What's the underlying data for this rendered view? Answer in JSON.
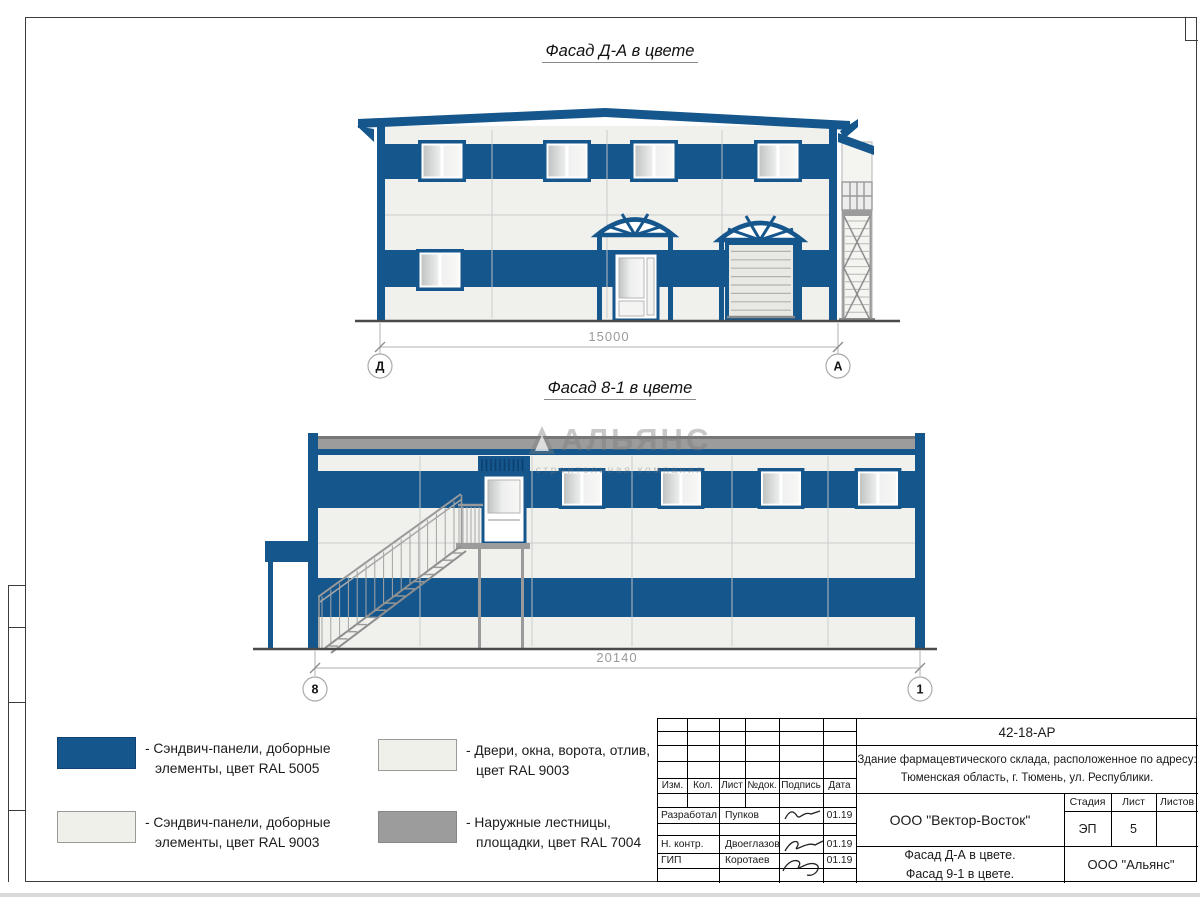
{
  "titles": {
    "facade1": "Фасад Д-А в цвете",
    "facade2": "Фасад 8-1 в цвете"
  },
  "facade1": {
    "dimension": "15000",
    "axis_left": "Д",
    "axis_right": "А"
  },
  "facade2": {
    "dimension": "20140",
    "axis_left": "8",
    "axis_right": "1"
  },
  "watermark": {
    "brand": "АЛЬЯНС",
    "tagline": "строительная компания"
  },
  "colors": {
    "panel_blue": "#15568C",
    "panel_white": "#F0F0EA",
    "stairs_gray": "#9C9C9C",
    "glass": "#D9DBDA"
  },
  "legend": {
    "items": [
      {
        "swatch": "#15568C",
        "line1": "- Сэндвич-панели, доборные",
        "line2": "элементы, цвет RAL 5005"
      },
      {
        "swatch": "#F0F0EA",
        "line1": "- Сэндвич-панели, доборные",
        "line2": "элементы, цвет RAL 9003"
      },
      {
        "swatch": "#F0F0EA",
        "line1": "- Двери, окна, ворота, отлив,",
        "line2": "цвет RAL 9003"
      },
      {
        "swatch": "#9C9C9C",
        "line1": "- Наружные лестницы,",
        "line2": "площадки, цвет RAL 7004"
      }
    ]
  },
  "tb": {
    "doc_number": "42-18-АР",
    "project_line1": "Здание фармацевтического склада, расположенное по адресу:",
    "project_line2": "Тюменская область, г. Тюмень, ул. Республики.",
    "cols": [
      "Изм.",
      "Кол.",
      "Лист",
      "№док.",
      "Подпись",
      "Дата"
    ],
    "rows": [
      {
        "role": "Разработал",
        "name": "Пупков",
        "date": "01.19"
      },
      {
        "role": "Н. контр.",
        "name": "Двоеглазов",
        "date": "01.19"
      },
      {
        "role": "ГИП",
        "name": "Коротаев",
        "date": "01.19"
      }
    ],
    "company": "ООО \"Вектор-Восток\"",
    "stage_label": "Стадия",
    "sheet_label": "Лист",
    "sheets_label": "Листов",
    "stage": "ЭП",
    "sheet": "5",
    "sheets": "",
    "subject_line1": "Фасад Д-А в цвете.",
    "subject_line2": "Фасад 9-1 в цвете.",
    "org": "ООО \"Альянс\""
  }
}
